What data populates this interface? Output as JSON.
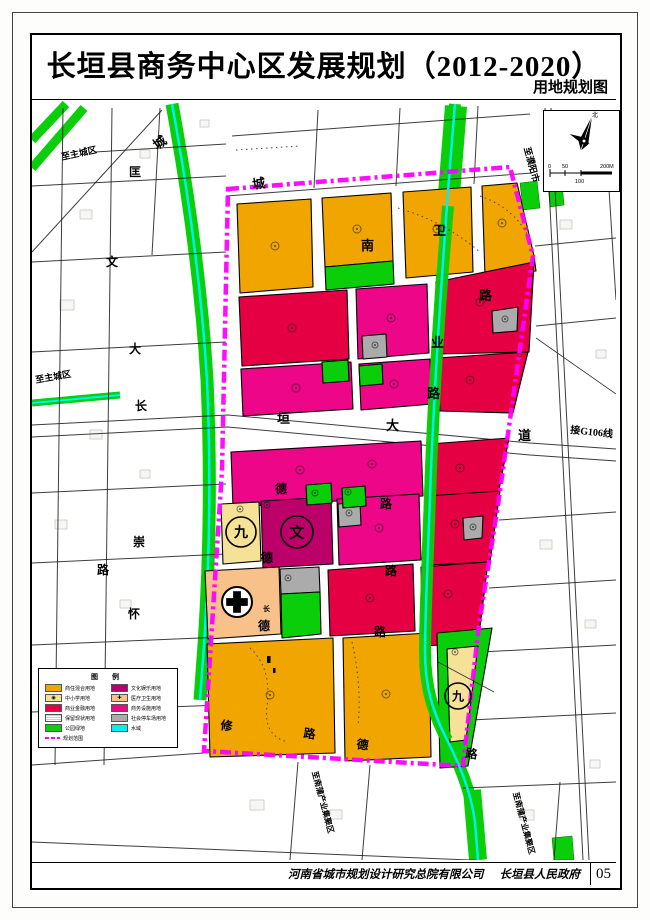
{
  "page": {
    "title": "长垣县商务中心区发展规划（2012-2020）",
    "subtitle": "用地规划图",
    "credits_company": "河南省城市规划设计研究总院有限公司",
    "credits_gov": "长垣县人民政府",
    "sheet_no": "05"
  },
  "palette": {
    "orange": "#F0A500",
    "red": "#E50043",
    "pink": "#EE0689",
    "purple": "#BB0069",
    "school": "#F6E296",
    "peach": "#F8C189",
    "gray": "#ABABAB",
    "green": "#0BCE0B",
    "cyan": "#00F0F0",
    "magenta": "#FF00FF"
  },
  "legend": {
    "title": "图 例",
    "left": [
      {
        "swatch": "orange",
        "type": "fill",
        "label": "商住混合用地"
      },
      {
        "swatch": "school",
        "type": "fill-circle",
        "label": "中小学用地"
      },
      {
        "swatch": "red",
        "type": "fill",
        "label": "商业金融用地"
      },
      {
        "swatch": "none",
        "type": "outline-dash",
        "label": "保留现状用地"
      },
      {
        "swatch": "green",
        "type": "fill",
        "label": "公园绿地"
      },
      {
        "swatch": "magenta",
        "type": "dash-line",
        "label": "规划范围"
      }
    ],
    "right": [
      {
        "swatch": "purple",
        "type": "fill",
        "label": "文化娱乐用地"
      },
      {
        "swatch": "peach",
        "type": "fill-cross",
        "label": "医疗卫生用地"
      },
      {
        "swatch": "pink",
        "type": "fill",
        "label": "商务设施用地"
      },
      {
        "swatch": "gray",
        "type": "fill",
        "label": "社会停车场用地"
      },
      {
        "swatch": "cyan",
        "type": "fill",
        "label": "水域"
      }
    ]
  },
  "north_scale": {
    "north_label": "北",
    "scale_ticks": [
      "0",
      "50",
      "100",
      "200M"
    ]
  },
  "map": {
    "road_labels": [
      {
        "t": "城",
        "x": 157,
        "y": 150,
        "r": -35,
        "s": 13
      },
      {
        "t": "匡",
        "x": 129,
        "y": 176,
        "r": 0,
        "s": 12
      },
      {
        "t": "文",
        "x": 106,
        "y": 266,
        "r": 0,
        "s": 12
      },
      {
        "t": "大",
        "x": 129,
        "y": 353,
        "r": 0,
        "s": 12
      },
      {
        "t": "长",
        "x": 135,
        "y": 410,
        "r": 0,
        "s": 12
      },
      {
        "t": "崇",
        "x": 133,
        "y": 546,
        "r": 0,
        "s": 12
      },
      {
        "t": "路",
        "x": 97,
        "y": 574,
        "r": 0,
        "s": 12
      },
      {
        "t": "怀",
        "x": 128,
        "y": 618,
        "r": 0,
        "s": 12
      },
      {
        "t": "城",
        "x": 253,
        "y": 189,
        "r": -8,
        "s": 13
      },
      {
        "t": "南",
        "x": 361,
        "y": 250,
        "r": 0,
        "s": 13
      },
      {
        "t": "卫",
        "x": 433,
        "y": 235,
        "r": 0,
        "s": 13
      },
      {
        "t": "业",
        "x": 431,
        "y": 347,
        "r": 0,
        "s": 13
      },
      {
        "t": "路",
        "x": 479,
        "y": 300,
        "r": 0,
        "s": 13
      },
      {
        "t": "路",
        "x": 427,
        "y": 398,
        "r": 0,
        "s": 13
      },
      {
        "t": "垣",
        "x": 277,
        "y": 423,
        "r": 0,
        "s": 13
      },
      {
        "t": "大",
        "x": 386,
        "y": 430,
        "r": 0,
        "s": 13
      },
      {
        "t": "道",
        "x": 518,
        "y": 440,
        "r": 0,
        "s": 13
      },
      {
        "t": "德",
        "x": 275,
        "y": 493,
        "r": 0,
        "s": 12
      },
      {
        "t": "路",
        "x": 380,
        "y": 508,
        "r": 0,
        "s": 12
      },
      {
        "t": "德",
        "x": 261,
        "y": 562,
        "r": 0,
        "s": 12
      },
      {
        "t": "路",
        "x": 385,
        "y": 575,
        "r": 0,
        "s": 12
      },
      {
        "t": "德",
        "x": 258,
        "y": 630,
        "r": 0,
        "s": 12
      },
      {
        "t": "路",
        "x": 374,
        "y": 636,
        "r": 0,
        "s": 12
      },
      {
        "t": "修",
        "x": 220,
        "y": 729,
        "r": 8,
        "s": 12
      },
      {
        "t": "路",
        "x": 303,
        "y": 737,
        "r": 8,
        "s": 12
      },
      {
        "t": "德",
        "x": 356,
        "y": 748,
        "r": 8,
        "s": 12
      },
      {
        "t": "路",
        "x": 465,
        "y": 757,
        "r": 8,
        "s": 12
      },
      {
        "t": "长",
        "x": 263,
        "y": 611,
        "r": 0,
        "s": 7
      }
    ],
    "area_labels": [
      {
        "t": "至主城区",
        "x": 62,
        "y": 160,
        "r": -12,
        "s": 9
      },
      {
        "t": "至主城区",
        "x": 36,
        "y": 383,
        "r": -10,
        "s": 9
      },
      {
        "t": "至濮阳市",
        "x": 524,
        "y": 148,
        "r": 75,
        "s": 9
      },
      {
        "t": "接G106线",
        "x": 570,
        "y": 433,
        "r": 6,
        "s": 10
      },
      {
        "t": "至南蒲产业集聚区",
        "x": 312,
        "y": 772,
        "r": 75,
        "s": 8
      },
      {
        "t": "至南蒲产业集聚区",
        "x": 513,
        "y": 793,
        "r": 75,
        "s": 8
      }
    ],
    "symbols": [
      {
        "kind": "circle-char",
        "t": "九",
        "x": 241,
        "y": 532,
        "rad": 15,
        "fs": 14
      },
      {
        "kind": "circle-char",
        "t": "文",
        "x": 297,
        "y": 532,
        "rad": 16,
        "fs": 15
      },
      {
        "kind": "circle-char",
        "t": "九",
        "x": 458,
        "y": 696,
        "rad": 13,
        "fs": 12
      },
      {
        "kind": "hospital-cross",
        "x": 237,
        "y": 602,
        "rad": 15
      }
    ]
  }
}
